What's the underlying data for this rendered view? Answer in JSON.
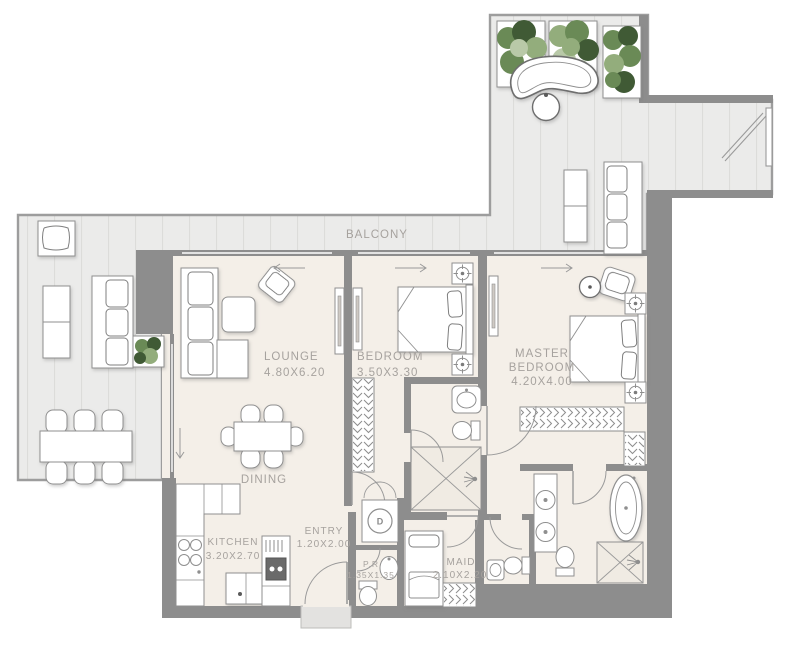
{
  "plan": {
    "rooms": {
      "balcony": {
        "label": "BALCONY"
      },
      "lounge": {
        "label": "LOUNGE",
        "dimensions": "4.80X6.20"
      },
      "bedroom": {
        "label": "BEDROOM",
        "dimensions": "3.50X3.30"
      },
      "master_bedroom": {
        "label_line1": "MASTER",
        "label_line2": "BEDROOM",
        "dimensions": "4.20X4.00"
      },
      "dining": {
        "label": "DINING"
      },
      "kitchen": {
        "label": "KITCHEN",
        "dimensions": "3.20X2.70"
      },
      "entry": {
        "label": "ENTRY",
        "dimensions": "1.20X2.00"
      },
      "powder_room": {
        "label": "P.R",
        "dimensions": "1.35X1.35"
      },
      "maid_room": {
        "label": "MAID",
        "dimensions": "2.10X2.20"
      }
    },
    "appliances": {
      "dryer_label": "D"
    },
    "colors": {
      "wall": "#8d8d8d",
      "balcony_floor": "#ebebea",
      "balcony_plank_line": "#dcdcda",
      "interior_floor": "#f4efe8",
      "label_text": "#a6a29e",
      "plant_dark": "#3f5a35",
      "plant_mid": "#6b8a57",
      "plant_light": "#93ad7c"
    }
  }
}
